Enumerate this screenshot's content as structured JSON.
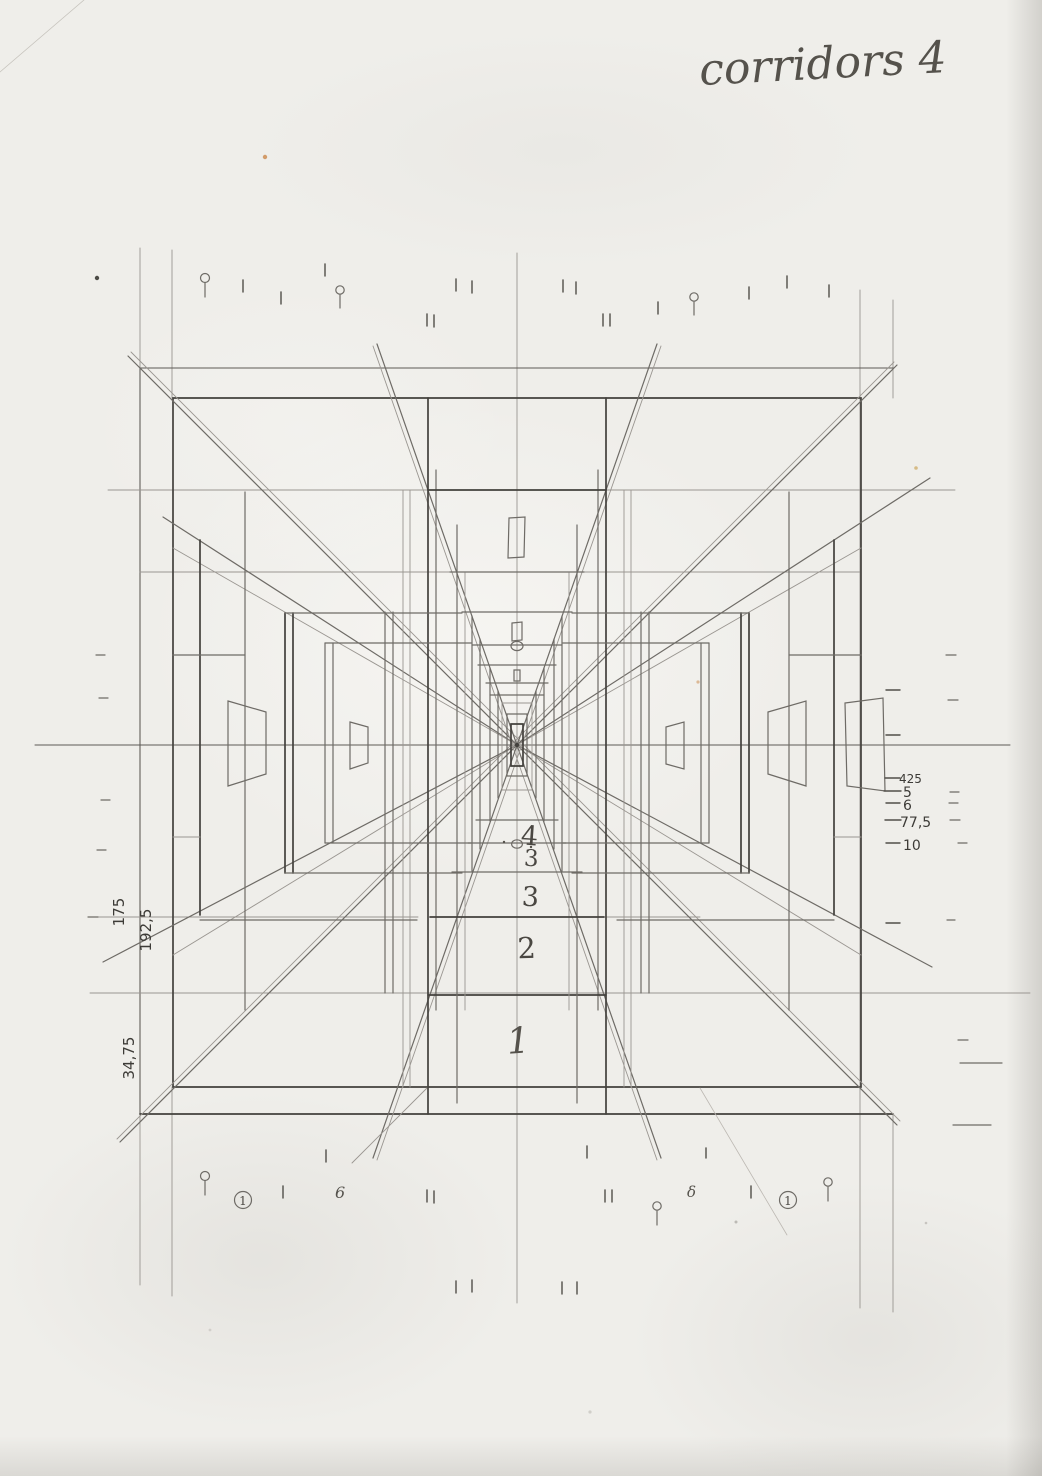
{
  "title": "corridors 4",
  "sketch": {
    "floor_labels": [
      "4",
      "3",
      "3",
      "2",
      "1"
    ],
    "right_axis_labels": [
      "425",
      "5",
      "6",
      "77,5",
      "10"
    ],
    "left_axis_labels": [
      "175",
      "192,5",
      "34,75"
    ],
    "bottom_marks": {
      "circled_left": "1",
      "circled_right": "1",
      "six_mark": "6",
      "delta_mark": "δ"
    }
  },
  "colors": {
    "paper": "#efeeea",
    "pencil_dark": "#43413d",
    "pencil_medium": "#6e6b66",
    "pencil_light": "#9a9691",
    "speck_orange": "#c8803f"
  }
}
